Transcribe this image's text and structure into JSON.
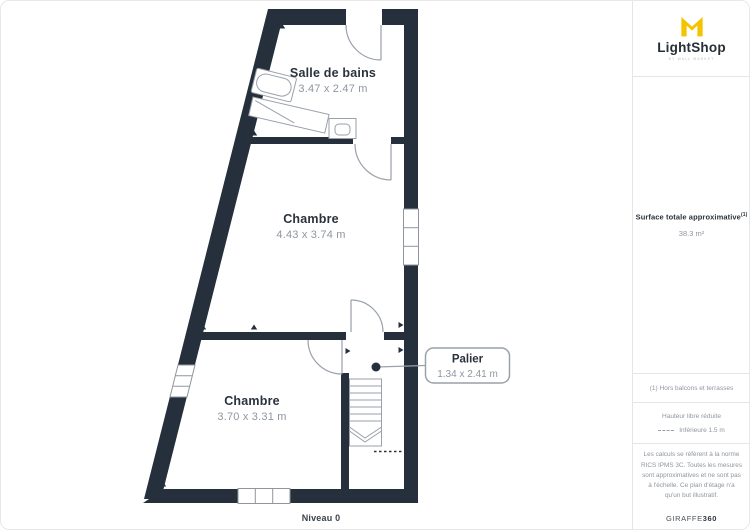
{
  "branding": {
    "logo_text": "LightShop",
    "logo_tagline": "BY WALL MARKET"
  },
  "sidebar": {
    "surface_label": "Surface totale approximative",
    "surface_superscript": "(1)",
    "surface_value": "38.3 m²",
    "footnote": "(1) Hors balcons et terrasses",
    "legend_title": "Hauteur libre réduite",
    "legend_item": "Inférieure 1.5 m",
    "disclaimer": "Les calculs se réfèrent à la norme RICS IPMS 3C. Toutes les mesures sont approximatives et ne sont pas à l'échelle. Ce plan d'étage n'a qu'un but illustratif.",
    "attribution_brand": "GIRAFFE",
    "attribution_suffix": "360"
  },
  "floorplan": {
    "level_label": "Niveau 0",
    "rooms": [
      {
        "name": "Salle de bains",
        "dimensions": "3.47 x 2.47 m"
      },
      {
        "name": "Chambre",
        "dimensions": "4.43 x 3.74 m"
      },
      {
        "name": "Chambre",
        "dimensions": "3.70 x 3.31 m"
      },
      {
        "name": "Palier",
        "dimensions": "1.34 x 2.41 m"
      }
    ]
  },
  "colors": {
    "wall": "#26303C",
    "fixture_stroke": "#9AA1AA",
    "text_dark": "#2A323D",
    "text_gray": "#8F969F",
    "divider": "#E5E5E5",
    "logo_yellow": "#F5C400"
  }
}
